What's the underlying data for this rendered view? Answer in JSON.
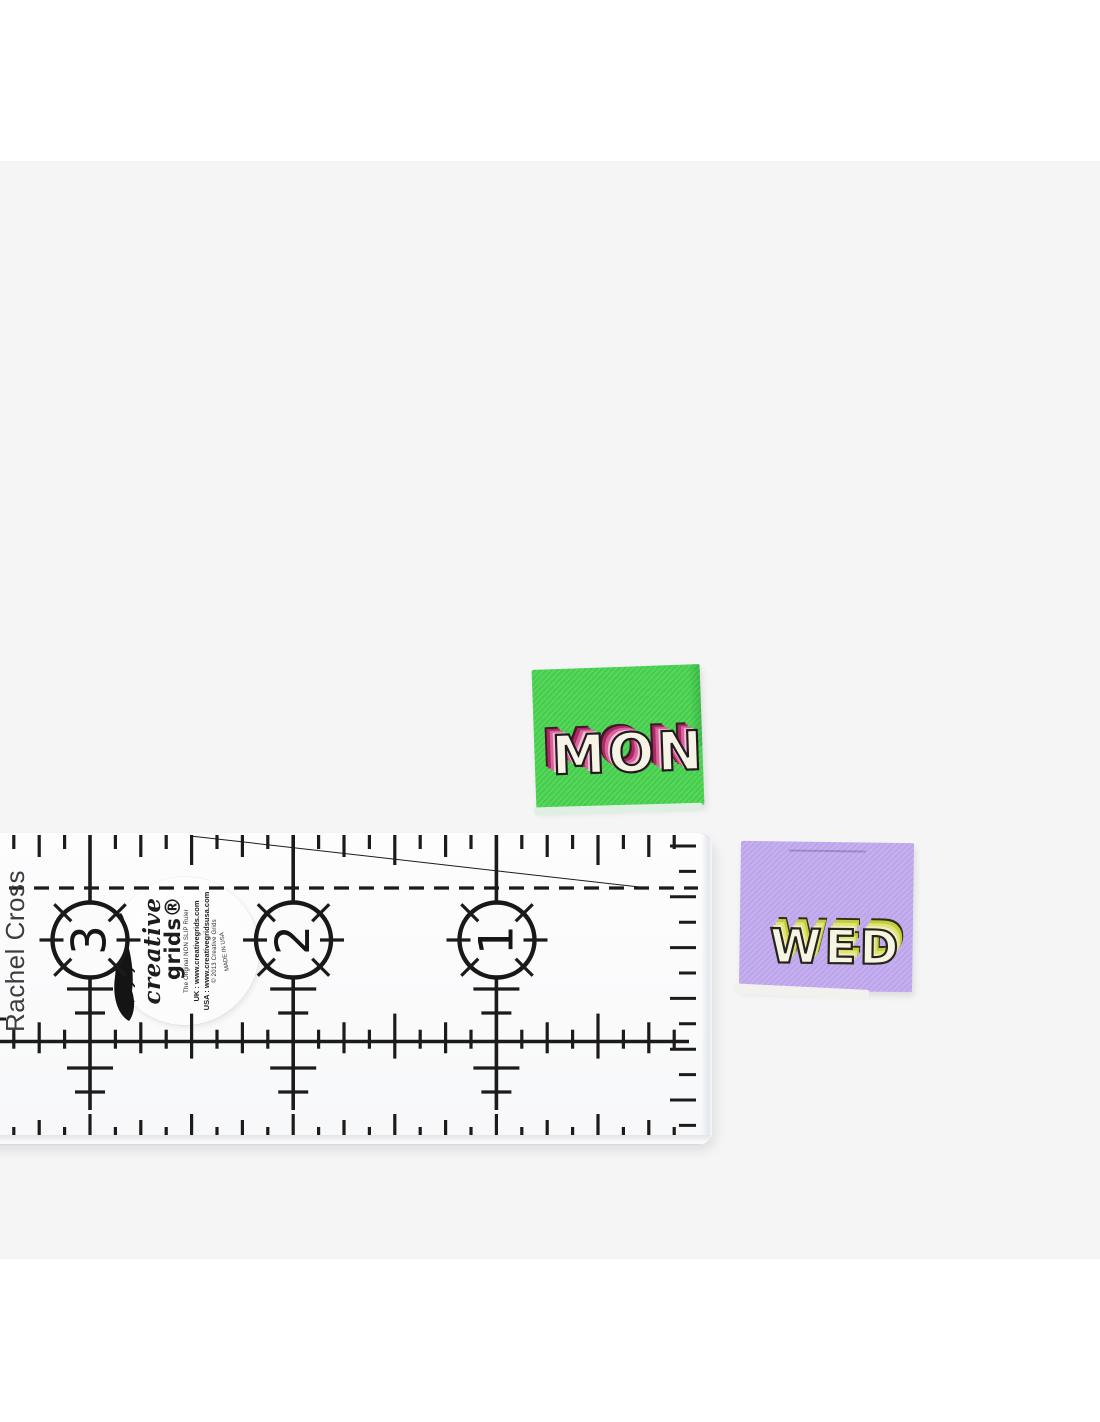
{
  "page": {
    "background": "#ffffff",
    "photo_background": "#f5f5f6"
  },
  "mon_label": {
    "text": "MON",
    "fabric_color": "#45d14c",
    "letter_color": "#f6f4e6",
    "shadow_light": "#f0bcd6",
    "shadow_dark": "#ab2a66",
    "outline_color": "#241a1e"
  },
  "wed_label": {
    "text": "WED",
    "fabric_color": "#c0a7ee",
    "letter_color": "#f6f4e3",
    "shadow_light": "#f0edba",
    "shadow_dark": "#c3cf3a",
    "outline_color": "#26231a"
  },
  "ruler": {
    "side_text": "Rachel Cross",
    "dial_numbers": [
      "3",
      "2",
      "1"
    ],
    "brand": {
      "script_word": "creative",
      "bold_word": "grids®",
      "tagline": "The Original NON SLIP Ruler",
      "uk_line": "UK : www.creativegrids.com",
      "usa_line": "USA : www.creativegridsusa.com",
      "copyright_line": "© 2013 Creative Grids",
      "made_in": "MADE IN USA"
    }
  }
}
